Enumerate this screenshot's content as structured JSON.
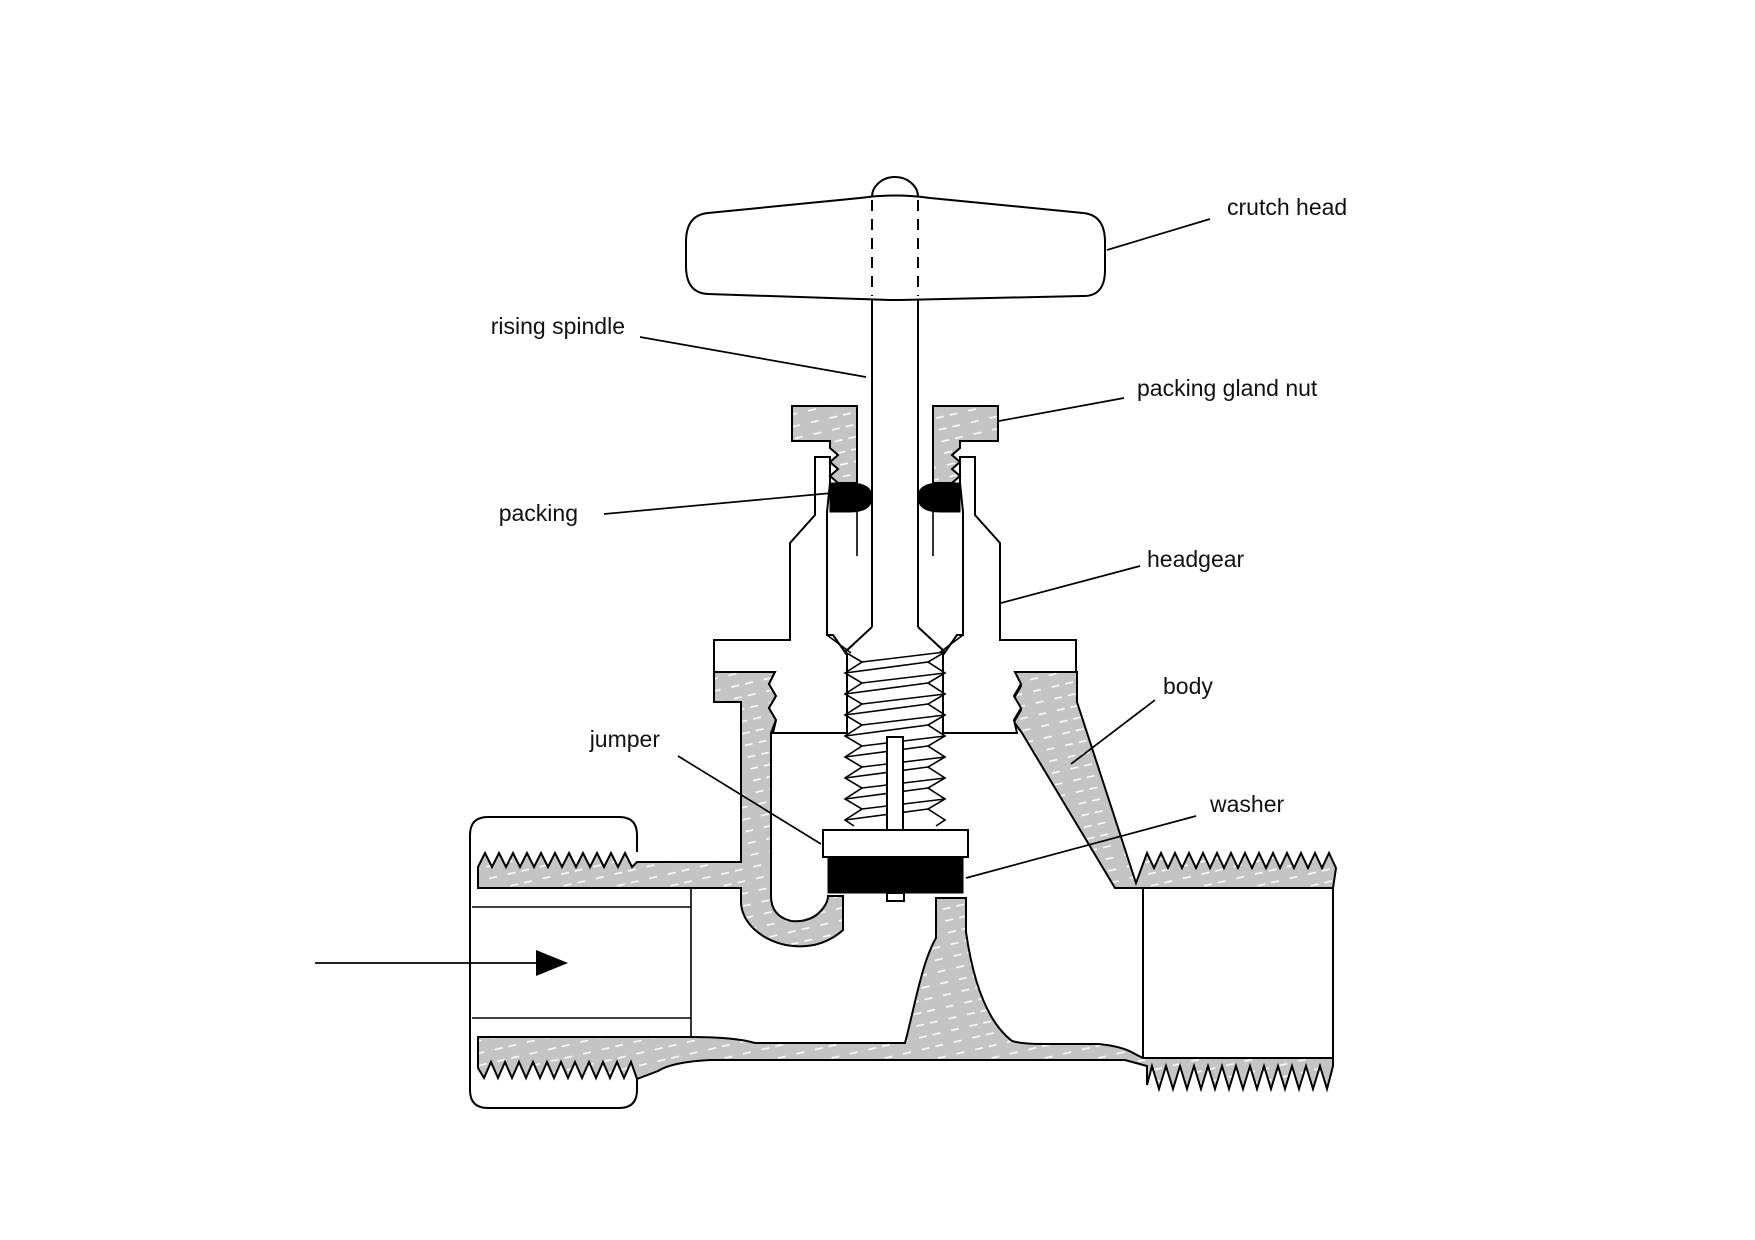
{
  "figure": {
    "kind": "technical sectional diagram",
    "subject": "stop valve (globe valve) cross-section",
    "background_color": "#ffffff",
    "line_color": "#000000",
    "sectioned_metal_color": "#c4c4c4",
    "seal_color": "#000000"
  },
  "labels": {
    "crutch_head": "crutch head",
    "rising_spindle": "rising spindle",
    "packing_gland_nut": "packing gland nut",
    "packing": "packing",
    "headgear": "headgear",
    "body": "body",
    "jumper": "jumper",
    "washer": "washer"
  },
  "flow_arrow": {
    "meaning": "flow direction into valve inlet",
    "direction": "right"
  }
}
